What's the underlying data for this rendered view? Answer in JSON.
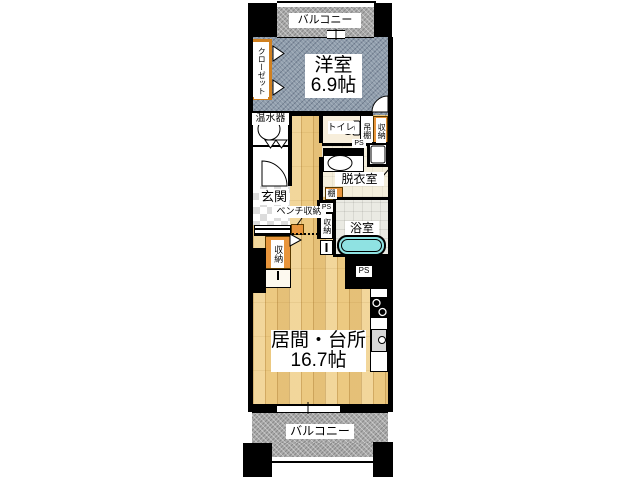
{
  "plan": {
    "type": "apartment-floorplan",
    "colors": {
      "wall": "#000000",
      "bedroom_carpet": "#8e9cab",
      "wood_floor": "#ecc981",
      "balcony": "#ababab",
      "storage_orange": "#e8953c",
      "bathtub": "#8fe2e2",
      "dressing_floor": "#f4eedb",
      "bath_floor": "#eaeae3",
      "entrance_checker": "#dcdcdc"
    },
    "rooms": {
      "balcony_top": {
        "label": "バルコニー"
      },
      "bedroom": {
        "name": "洋室",
        "size": "6.9帖"
      },
      "closet": {
        "label": "クローゼット"
      },
      "water_heater": {
        "label": "温水器"
      },
      "toilet": {
        "label": "トイレ"
      },
      "hanging_shelf": {
        "label": "吊棚"
      },
      "storage_top_right": {
        "label": "収納"
      },
      "ps_1": {
        "label": "PS"
      },
      "dressing_room": {
        "label": "脱衣室"
      },
      "shelf": {
        "label": "棚"
      },
      "entrance": {
        "label": "玄関"
      },
      "bench_storage": {
        "label": "ベンチ収納"
      },
      "ps_2": {
        "label": "PS"
      },
      "storage_mid": {
        "label": "収納"
      },
      "bathroom": {
        "label": "浴室"
      },
      "storage_left": {
        "label": "収納"
      },
      "ps_3": {
        "label": "PS"
      },
      "living_kitchen": {
        "name": "居間・台所",
        "size": "16.7帖"
      },
      "balcony_bottom": {
        "label": "バルコニー"
      }
    }
  }
}
